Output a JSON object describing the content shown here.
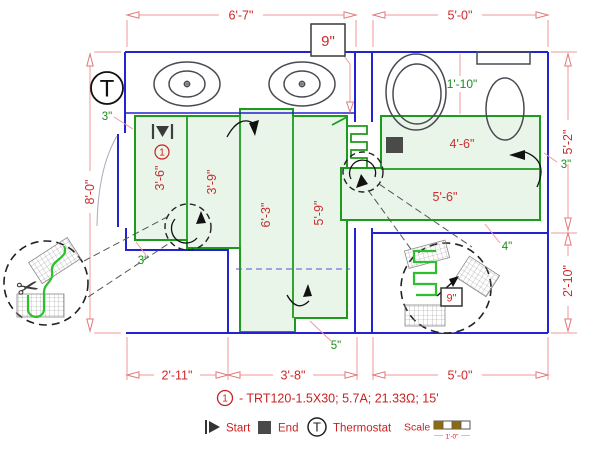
{
  "plan": {
    "dim_top_left": "6'-7\"",
    "dim_top_right": "5'-0\"",
    "dim_left": "8'-0\"",
    "dim_right_upper": "5'-2\"",
    "dim_right_lower": "2'-10\"",
    "dim_bottom_left": "2'-11\"",
    "dim_bottom_mid": "3'-8\"",
    "dim_bottom_right": "5'-0\"",
    "mat_strip1": "3'-6\"",
    "mat_strip2": "3'-9\"",
    "mat_strip3": "6'-3\"",
    "mat_strip4": "5'-9\"",
    "mat_right_upper": "4'-6\"",
    "mat_right_lower": "5'-6\"",
    "gap_top_left": "3\"",
    "gap_bottom_left": "3\"",
    "gap_bottom_center": "5\"",
    "gap_right_bottom": "4\"",
    "gap_right": "3\"",
    "gap_fixture": "1'-10\"",
    "spacing_box": "9\"",
    "circuit_number": "1",
    "thermostat_letter": "T"
  },
  "detail": {
    "spacing_box": "9\""
  },
  "legend": {
    "item_number": "1",
    "item_text": "- TRT120-1.5X30; 5.7A; 21.33Ω; 15'",
    "start_label": "Start",
    "end_label": "End",
    "thermostat_letter": "T",
    "thermostat_label": "Thermostat",
    "scale_label": "Scale",
    "scale_length": "1'-0\""
  },
  "icons": {
    "scissors": "✂"
  },
  "colors": {
    "wall": "#2323cf",
    "mat_stroke": "#1d9b1d",
    "mat_fill": "#e9f5e9",
    "dim_line": "#f09a9a",
    "dim_text": "#d02828",
    "green_text": "#1e8c1e",
    "fixture": "#4a4a52",
    "scale_bar": "#8a6a14"
  }
}
